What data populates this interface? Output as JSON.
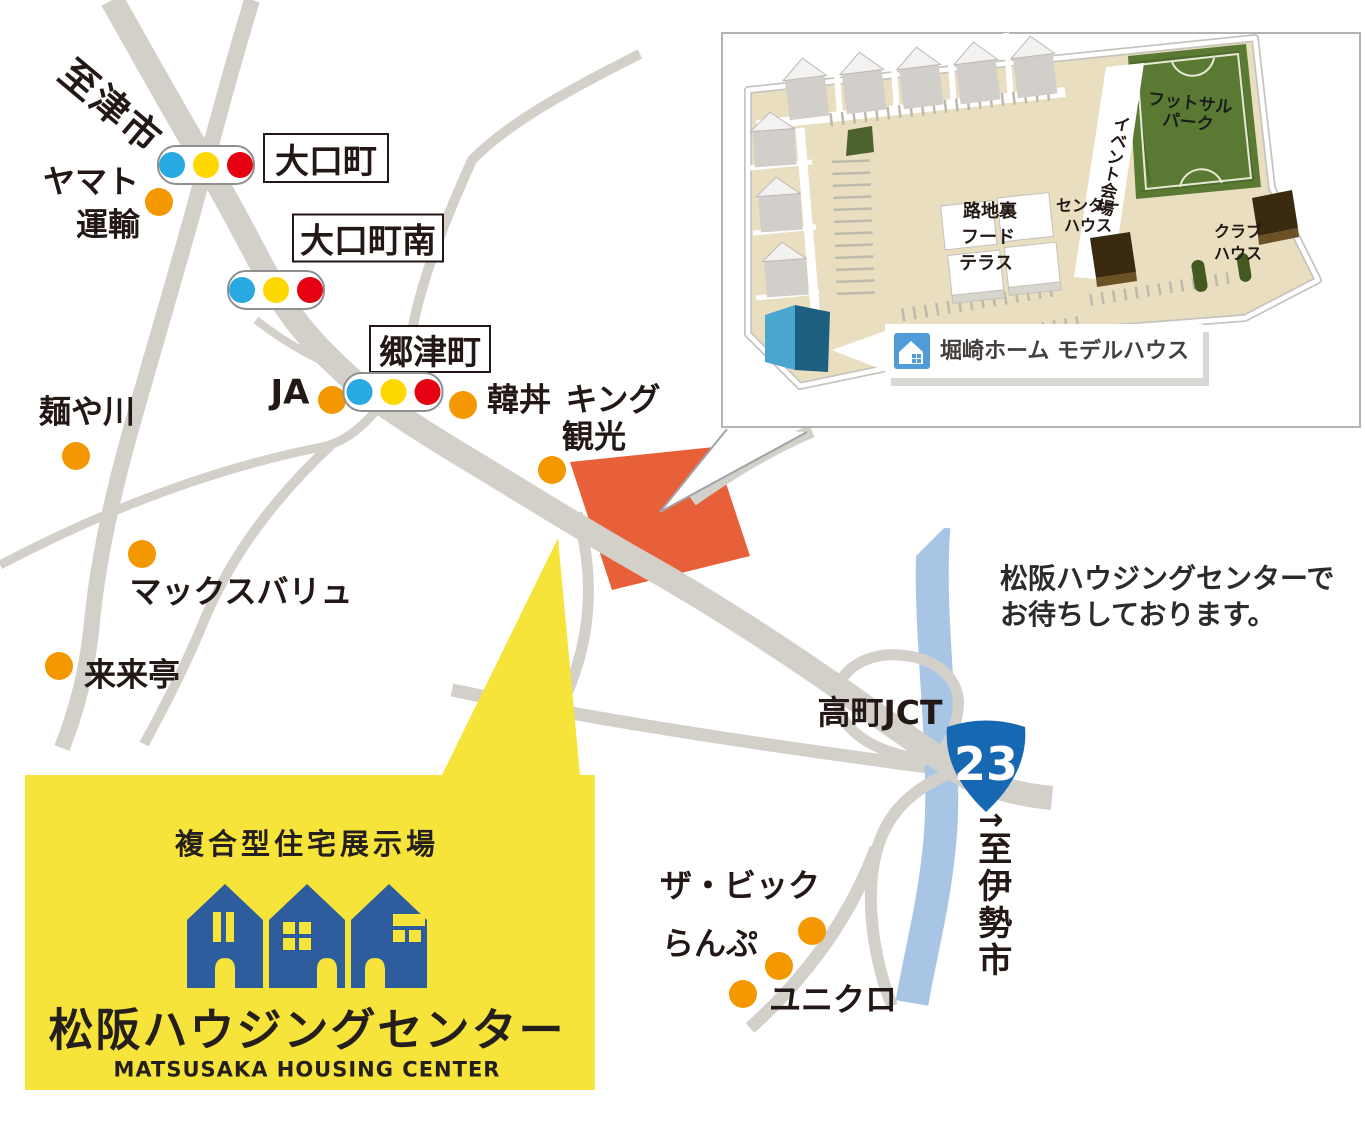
{
  "map": {
    "area_labels": {
      "to_tsu_city": "至津市",
      "takamachi_jct": "高町JCT",
      "to_ise_arrow": "→",
      "to_ise_city": "至伊勢市"
    },
    "intersections": {
      "oguchicho": "大口町",
      "oguchicho_minami": "大口町南",
      "gozucho": "郷津町"
    },
    "landmarks": {
      "yamato_line1": "ヤマト",
      "yamato_line2": "運輸",
      "ja": "JA",
      "kandon": "韓丼",
      "king_kanko_line1": "キング",
      "king_kanko_line2": "観光",
      "menyakawa": "麺や川",
      "maxvalu": "マックスバリュ",
      "rairaitei": "来来亭",
      "the_big": "ザ・ビック",
      "lamp": "らんぷ",
      "uniqlo": "ユニクロ"
    },
    "route_badge": {
      "number": "23"
    },
    "message_line1": "松阪ハウジングセンターで",
    "message_line2": "お待ちしております。"
  },
  "inset": {
    "futsal_line1": "フットサル",
    "futsal_line2": "パーク",
    "event_hall": "イベント会場",
    "center_house_line1": "センター",
    "center_house_line2": "ハウス",
    "food_terrace_line1": "路地裏",
    "food_terrace_line2": "フード",
    "food_terrace_line3": "テラス",
    "club_house_line1": "クラブ",
    "club_house_line2": "ハウス",
    "model_house_label": "堀崎ホーム モデルハウス"
  },
  "center_box": {
    "tagline": "複合型住宅展示場",
    "title": "松阪ハウジングセンター",
    "subtitle": "MATSUSAKA HOUSING CENTER"
  },
  "colors": {
    "road_gray": "#d3d0ca",
    "highway_blue": "#a8c5e6",
    "landmark_dot_orange": "#f39800",
    "site_orange": "#e8603a",
    "box_yellow": "#f7e43a",
    "brand_blue": "#2e5d9e",
    "badge_blue": "#1668b2",
    "signal_blue": "#29a9e1",
    "signal_yellow": "#ffd800",
    "signal_red": "#e60012",
    "text_dark": "#231815"
  }
}
